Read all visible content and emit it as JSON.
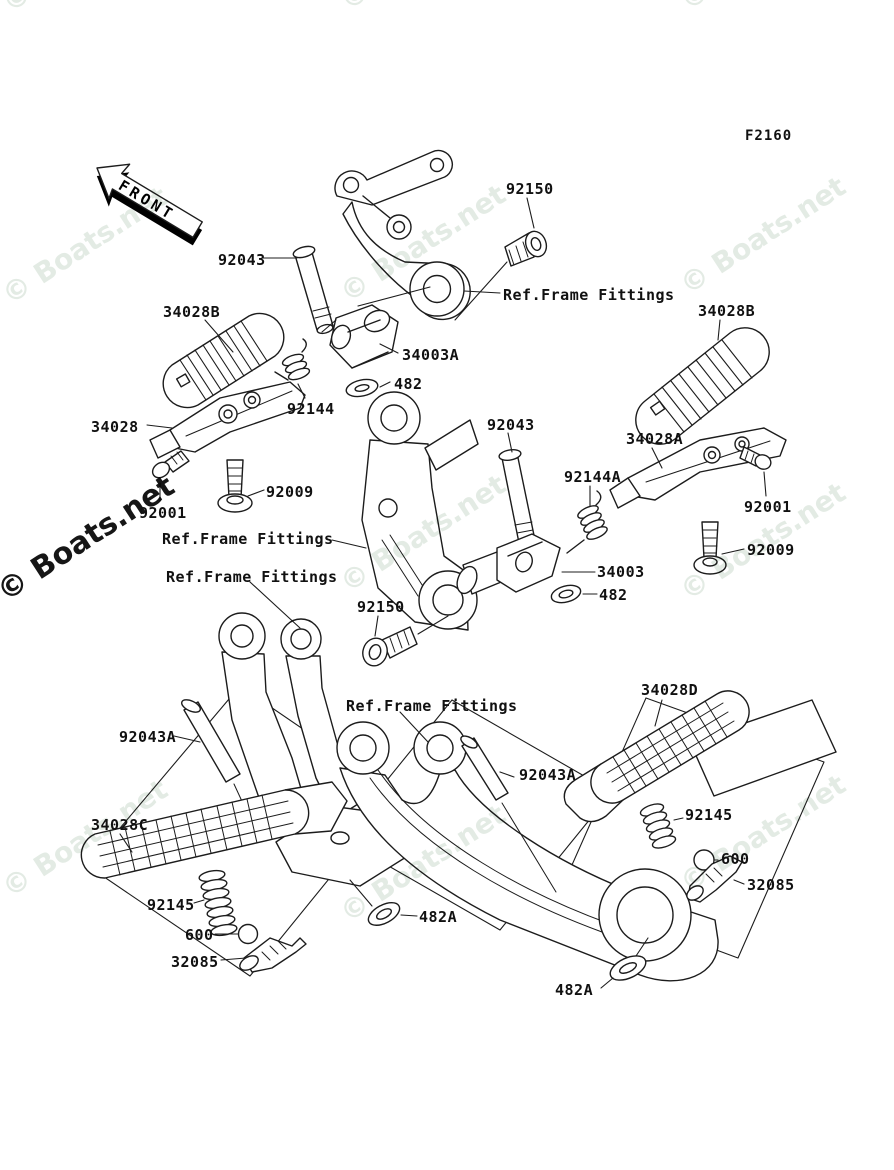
{
  "diagram_code": "F2160",
  "front_arrow": {
    "label": "FRONT"
  },
  "watermark": {
    "text": "© Boats.net",
    "light_color": "#e3ebe4",
    "dark_color": "#161616"
  },
  "line_color": "#1c1c1c",
  "labels": [
    {
      "id": "diagram-code",
      "text": "F2160"
    },
    {
      "id": "92150-top",
      "text": "92150"
    },
    {
      "id": "92043-top",
      "text": "92043"
    },
    {
      "id": "34028B-left",
      "text": "34028B"
    },
    {
      "id": "ref-frame-fittings-top",
      "text": "Ref.Frame Fittings"
    },
    {
      "id": "34003A",
      "text": "34003A"
    },
    {
      "id": "482-mid",
      "text": "482"
    },
    {
      "id": "92144",
      "text": "92144"
    },
    {
      "id": "34028",
      "text": "34028"
    },
    {
      "id": "92009-left",
      "text": "92009"
    },
    {
      "id": "92001-left",
      "text": "92001"
    },
    {
      "id": "92043-mid",
      "text": "92043"
    },
    {
      "id": "92144A",
      "text": "92144A"
    },
    {
      "id": "34028A",
      "text": "34028A"
    },
    {
      "id": "34028B-right",
      "text": "34028B"
    },
    {
      "id": "92001-right",
      "text": "92001"
    },
    {
      "id": "92009-right",
      "text": "92009"
    },
    {
      "id": "34003",
      "text": "34003"
    },
    {
      "id": "482-right",
      "text": "482"
    },
    {
      "id": "ref-frame-fittings-mid1",
      "text": "Ref.Frame Fittings"
    },
    {
      "id": "ref-frame-fittings-mid2",
      "text": "Ref.Frame Fittings"
    },
    {
      "id": "92150-bottom",
      "text": "92150"
    },
    {
      "id": "ref-frame-fittings-bot",
      "text": "Ref.Frame Fittings"
    },
    {
      "id": "34028D",
      "text": "34028D"
    },
    {
      "id": "92043A-left",
      "text": "92043A"
    },
    {
      "id": "92043A-right",
      "text": "92043A"
    },
    {
      "id": "34028C",
      "text": "34028C"
    },
    {
      "id": "92145-left",
      "text": "92145"
    },
    {
      "id": "600-left",
      "text": "600"
    },
    {
      "id": "32085-left",
      "text": "32085"
    },
    {
      "id": "92145-right",
      "text": "92145"
    },
    {
      "id": "600-right",
      "text": "600"
    },
    {
      "id": "32085-right",
      "text": "32085"
    },
    {
      "id": "482A-mid",
      "text": "482A"
    },
    {
      "id": "482A-bottom",
      "text": "482A"
    }
  ]
}
